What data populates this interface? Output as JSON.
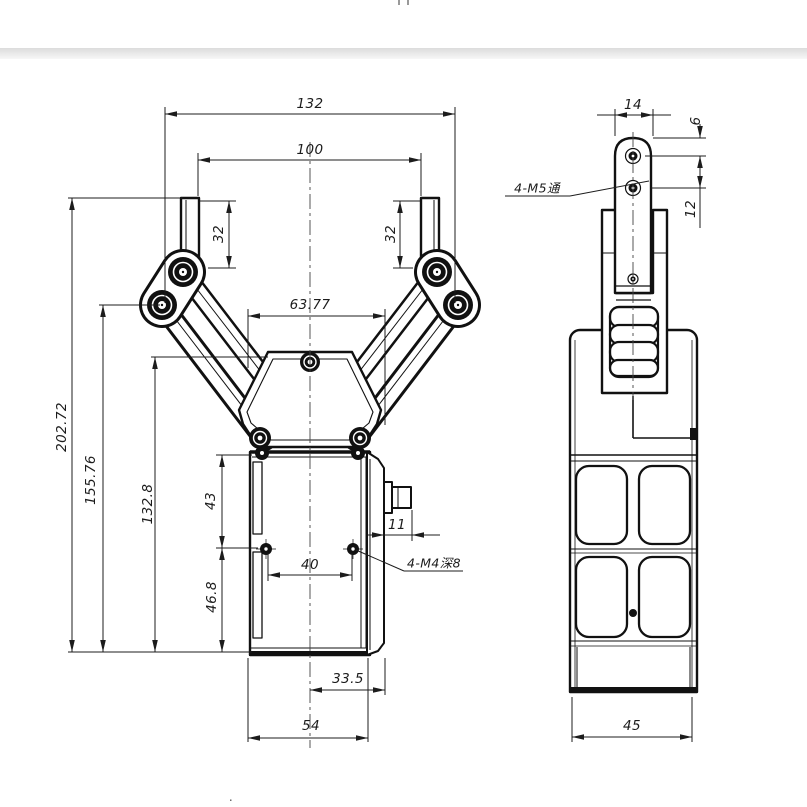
{
  "front": {
    "dims": {
      "overall_width": "132",
      "finger_span": "100",
      "finger_left_len": "32",
      "finger_right_len": "32",
      "link_span": "63.77",
      "overall_height": "202.72",
      "elbow_height": "155.76",
      "palm_height": "132.8",
      "body_upper": "43",
      "body_lower": "46.8",
      "hole_pitch": "40",
      "connector_len": "11",
      "center_to_plate": "33.5",
      "body_width": "54"
    },
    "notes": {
      "m4": "4-M4深8"
    }
  },
  "side": {
    "dims": {
      "finger_width": "14",
      "hole_top_offset": "6",
      "hole_pitch": "12",
      "body_width": "45"
    },
    "notes": {
      "m5": "4-M5通"
    }
  },
  "artifacts": {
    "bottom_dot": "."
  }
}
